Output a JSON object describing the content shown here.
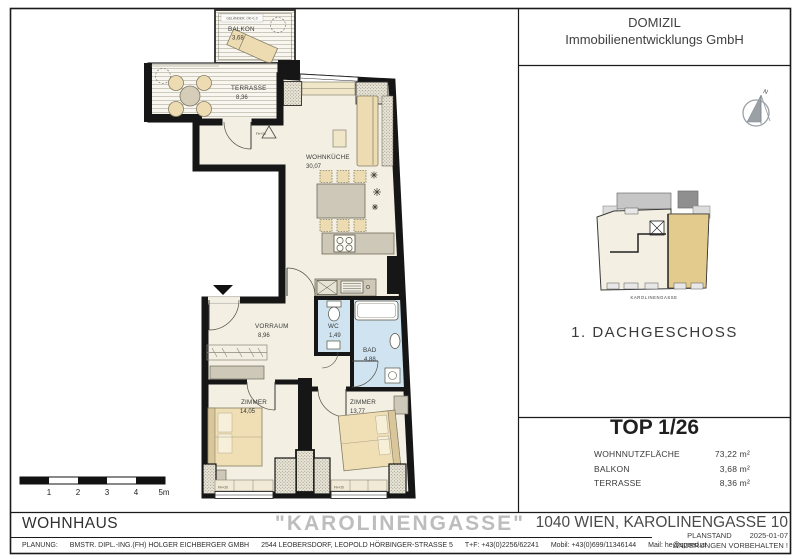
{
  "company": {
    "line1": "DOMIZIL",
    "line2": "Immobilienentwicklungs GmbH"
  },
  "compass": {
    "north_label": "N"
  },
  "overview_plan": {
    "street_caption": "KAROLINENGASSE",
    "floor_title": "1. DACHGESCHOSS"
  },
  "unit_summary": {
    "title": "TOP 1/26",
    "rows": [
      {
        "label": "WOHNNUTZFLÄCHE",
        "value": "73,22 m²"
      },
      {
        "label": "BALKON",
        "value": "3,68 m²"
      },
      {
        "label": "TERRASSE",
        "value": "8,36 m²"
      }
    ]
  },
  "floor_plan": {
    "rooms": [
      {
        "name": "BALKON",
        "area": "3,68"
      },
      {
        "name": "TERRASSE",
        "area": "8,36"
      },
      {
        "name": "WOHNKÜCHE",
        "area": "30,07"
      },
      {
        "name": "VORRAUM",
        "area": "8,96"
      },
      {
        "name": "WC",
        "area": "1,49"
      },
      {
        "name": "BAD",
        "area": "4,88"
      },
      {
        "name": "ZIMMER",
        "area": "14,05"
      },
      {
        "name": "ZIMMER",
        "area": "13,77"
      }
    ],
    "railing_note": "GELÄNDER, OK+1.0",
    "window_labels": [
      "FH+20",
      "FH+20",
      "FH+20"
    ],
    "scale_bar": {
      "ticks": [
        "1",
        "2",
        "3",
        "4",
        "5m"
      ]
    }
  },
  "title_block": {
    "building_type": "WOHNHAUS",
    "project_name": "\"KAROLINENGASSE\"",
    "address": "1040 WIEN, KAROLINENGASSE 10",
    "plan_status_label": "PLANSTAND",
    "plan_status_date": "2025-01-07",
    "disclaimer": "ÄNDERUNGEN VORBEHALTEN !"
  },
  "footer": {
    "segments": [
      "PLANUNG:",
      "BMSTR. DIPL.-ING.(FH) HOLGER EICHBERGER GMBH",
      "2544 LEOBERSDORF, LEOPOLD HÖRBINGER-STRASSE 5",
      "T+F: +43(0)2256/62241",
      "Mobil: +43(0)699/11346144",
      "Mail: he@speed.at"
    ]
  },
  "colors": {
    "room_fill": "#f3efe2",
    "wet_room_fill": "#cfe4f0",
    "furniture_beige": "#eddcb1",
    "furniture_gray": "#cdc8b8",
    "wall": "#161616",
    "highlight_unit": "#e3cb8e",
    "project_name_gray": "#bdbdbd"
  }
}
